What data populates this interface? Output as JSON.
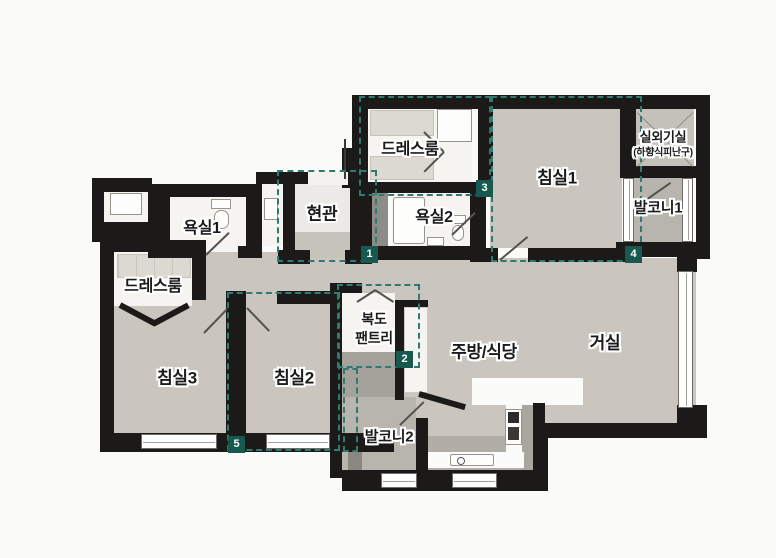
{
  "meta": {
    "type": "floor-plan",
    "style": "korean-apartment-unit-plan"
  },
  "colors": {
    "background": "#fafaf8",
    "wall": "#1b1a18",
    "floor": "#cac6bf",
    "room_white": "#f5f4f1",
    "balcony": "#b8b5ae",
    "outdoor_unit": "#c4c1ba",
    "shaft": "#8e8c86",
    "entry_step": "#c6c3bb",
    "counter_gray": "#b1aea7",
    "accent_teal": "#17594f",
    "dash_teal": "#2f7b73"
  },
  "rooms": {
    "dress_top": {
      "label": "드레스룸"
    },
    "bedroom1": {
      "label": "침실1"
    },
    "outdoor_unit": {
      "label": "실외기실",
      "sublabel": "(하향식피난구)"
    },
    "balcony1": {
      "label": "발코니1"
    },
    "bath1": {
      "label": "욕실1"
    },
    "entry": {
      "label": "현관"
    },
    "bath2": {
      "label": "욕실2"
    },
    "dress_left": {
      "label": "드레스룸"
    },
    "bedroom3": {
      "label": "침실3"
    },
    "bedroom2": {
      "label": "침실2"
    },
    "corridor": {
      "label": "복도",
      "label2": "팬트리"
    },
    "kitchen": {
      "label": "주방/식당"
    },
    "living": {
      "label": "거실"
    },
    "balcony2": {
      "label": "발코니2"
    }
  },
  "markers": [
    {
      "number": "1"
    },
    {
      "number": "2"
    },
    {
      "number": "3"
    },
    {
      "number": "4"
    },
    {
      "number": "5"
    }
  ]
}
